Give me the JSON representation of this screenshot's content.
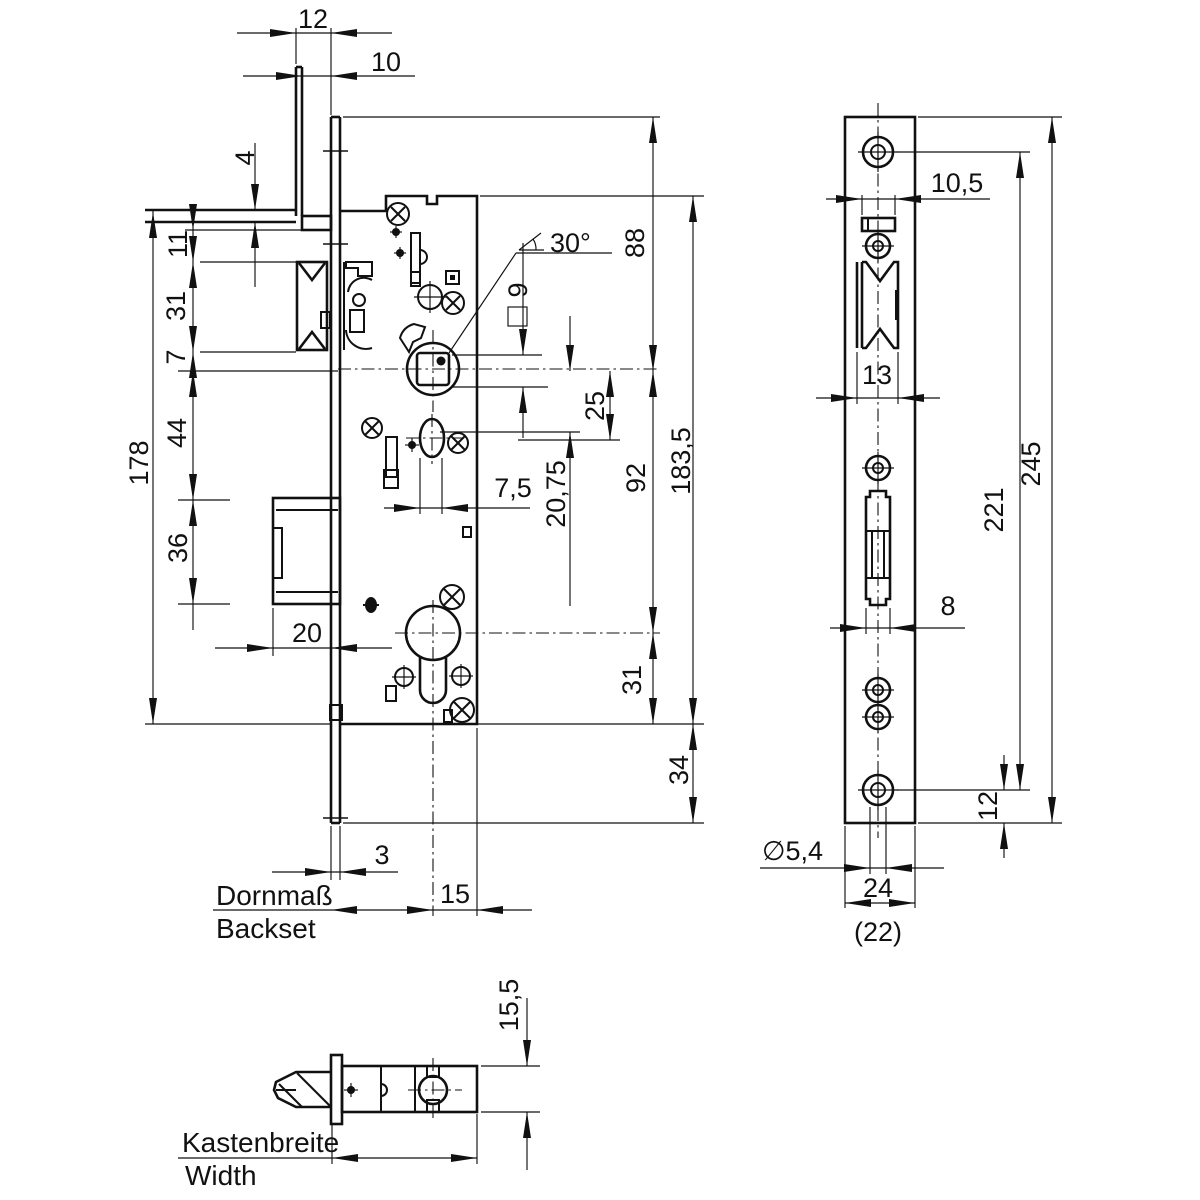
{
  "views": {
    "front": {
      "dims": {
        "d12": "12",
        "d10": "10",
        "d4": "4",
        "d178": "178",
        "d11": "11",
        "d31": "31",
        "d7": "7",
        "d44": "44",
        "d36": "36",
        "d20": "20",
        "d3": "3",
        "d15": "15",
        "d30deg": "30°",
        "d9": "9",
        "d2075": "20,75",
        "d25": "25",
        "d75": "7,5",
        "d88": "88",
        "d92": "92",
        "d1835": "183,5",
        "d31b": "31",
        "d34": "34"
      },
      "labels": {
        "backset_de": "Dornmaß",
        "backset_en": "Backset"
      }
    },
    "faceplate": {
      "dims": {
        "d105": "10,5",
        "d13": "13",
        "d245": "245",
        "d221": "221",
        "d8": "8",
        "d12": "12",
        "d54": "∅5,4",
        "d24": "24",
        "d22": "(22)"
      }
    },
    "bottom": {
      "dims": {
        "d155": "15,5"
      },
      "labels": {
        "width_de": "Kastenbreite",
        "width_en": "Width"
      }
    }
  }
}
